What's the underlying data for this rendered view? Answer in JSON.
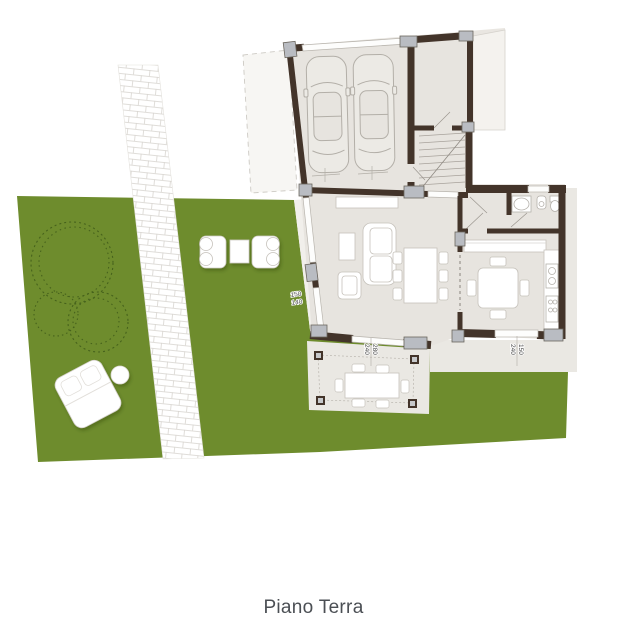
{
  "caption": "Piano Terra",
  "dimension_labels": {
    "living_left_window": {
      "width": "150",
      "height": "140"
    },
    "living_bottom_window": {
      "width": "280",
      "height": "240"
    },
    "kitchen_window": {
      "width": "150",
      "height": "240"
    }
  },
  "colors": {
    "garden_green": "#6e8c2d",
    "tree_outline": "#46621c",
    "wall_brown": "#43342a",
    "floor_gray": "#e7e4df",
    "paving_gray": "#eae8e3",
    "pillar_gray": "#b9bcc2",
    "furniture_white": "#ffffff",
    "caption_text": "#4b4f54"
  }
}
